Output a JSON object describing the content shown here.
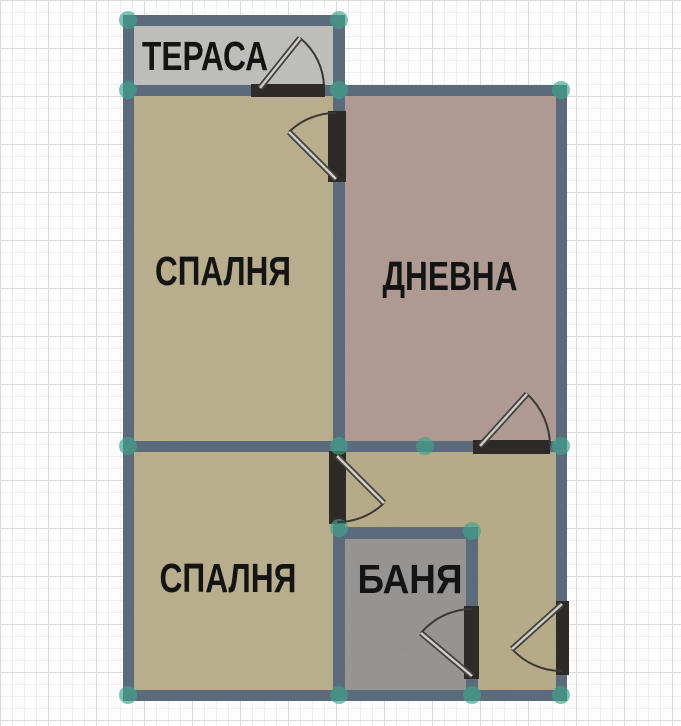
{
  "floorplan": {
    "rooms": [
      {
        "id": "terrace",
        "label": "ТЕРАСА"
      },
      {
        "id": "bedroom-top",
        "label": "СПАЛНЯ"
      },
      {
        "id": "living-room",
        "label": "ДНЕВНА"
      },
      {
        "id": "bedroom-bottom",
        "label": "СПАЛНЯ"
      },
      {
        "id": "bathroom",
        "label": "БАНЯ"
      }
    ],
    "doors": [
      {
        "name": "terrace-door"
      },
      {
        "name": "bedroom-top-door"
      },
      {
        "name": "living-room-door"
      },
      {
        "name": "bedroom-bottom-door"
      },
      {
        "name": "bathroom-door"
      },
      {
        "name": "entrance-door"
      }
    ],
    "colors": {
      "wall": "#5b6b7c",
      "door_frame": "#2e2a27",
      "door_arc": "#3a3833",
      "floor_terrace": "#dadad7",
      "floor_bedroom": "#d5c8a2",
      "floor_living": "#c9b2a9",
      "floor_hallway": "#d3c69f",
      "floor_bathroom": "#c7c6c4",
      "junction_marker": "#3fa58c",
      "label_text": "#141414",
      "grid_minor": "#eef0f3",
      "grid_major": "#d8dbdf",
      "background": "#fdfdfd"
    }
  }
}
